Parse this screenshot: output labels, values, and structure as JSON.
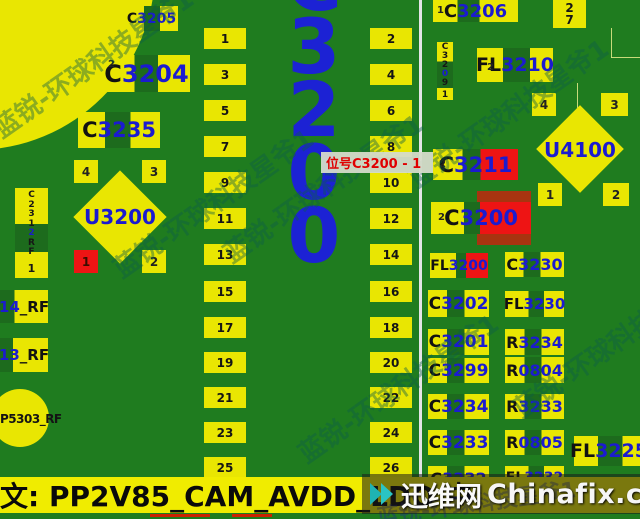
{
  "colors": {
    "board_green": "#1f7c1f",
    "pad_yellow": "#e9e602",
    "mid_green": "#1d6b1d",
    "highlight_red": "#ee1414",
    "marker_dark_red": "#a83410",
    "label_blue": "#1b1bd0",
    "big_label_blue": "#1c22d4",
    "tooltip_text_red": "#e00000",
    "bar_yellow": "#f0ec00"
  },
  "big_label": {
    "text": "C3200"
  },
  "tooltip": {
    "text": "位号C3200 - 1"
  },
  "connector": {
    "left_pins": [
      "1",
      "3",
      "5",
      "7",
      "9",
      "11",
      "13",
      "15",
      "17",
      "19",
      "21",
      "23",
      "25"
    ],
    "right_pins": [
      "2",
      "4",
      "6",
      "8",
      "10",
      "12",
      "14",
      "16",
      "18",
      "20",
      "22",
      "24",
      "26"
    ]
  },
  "refs": {
    "c3205": {
      "p": "C",
      "d": "3205"
    },
    "c3204": {
      "p": "C",
      "d": "3204",
      "pad": "2"
    },
    "c3235": {
      "p": "C",
      "d": "3235"
    },
    "u3200": {
      "label": "U3200",
      "pads": [
        "4",
        "3",
        "1",
        "2"
      ]
    },
    "c2312": {
      "t1": "C231",
      "t2": "2",
      "t3": "RF",
      "pad": "1"
    },
    "rf14": {
      "num": "14",
      "suffix": "_RF"
    },
    "rf13": {
      "num": "13",
      "suffix": "_RF"
    },
    "p5303": {
      "label": "P5303_RF"
    },
    "c3206": {
      "p": "C",
      "d": "3206",
      "pad": "1"
    },
    "pad27": {
      "a": "2",
      "b": "7"
    },
    "c3209": {
      "t1": "C32",
      "t2": "0",
      "t3": "9",
      "pad": "1"
    },
    "fl3210": {
      "p": "FL",
      "d": "3210",
      "pad": "2"
    },
    "u4100": {
      "label": "U4100",
      "pads": [
        "4",
        "3",
        "1",
        "2"
      ]
    },
    "c3211": {
      "p": "C",
      "d": "3211",
      "pad": "2"
    },
    "c3200": {
      "p": "C",
      "d": "3200",
      "pad": "2"
    },
    "fl3200": {
      "p": "FL",
      "d": "3200"
    },
    "c3230": {
      "p": "C",
      "d": "3230"
    },
    "c3202": {
      "p": "C",
      "d": "3202"
    },
    "fl3230": {
      "p": "FL",
      "d": "3230"
    },
    "c3201": {
      "p": "C",
      "d": "3201"
    },
    "r3234": {
      "p": "R",
      "d": "3234"
    },
    "c3299": {
      "p": "C",
      "d": "3299"
    },
    "r0804": {
      "p": "R",
      "d": "0804"
    },
    "c3234": {
      "p": "C",
      "d": "3234"
    },
    "r3233": {
      "p": "R",
      "d": "3233"
    },
    "c3233": {
      "p": "C",
      "d": "3233"
    },
    "r0805": {
      "p": "R",
      "d": "0805"
    },
    "c3232": {
      "p": "C",
      "d": "3232"
    },
    "fl3232": {
      "p": "FL",
      "d": "3232"
    },
    "fl3225": {
      "p": "FL",
      "d": "3225"
    }
  },
  "bottom_bar": {
    "text": "文: PP2V85_CAM_AVDD_LDO 中"
  },
  "watermark": {
    "badge": "迅维网",
    "site": "Chinafix.com",
    "diagonal": "蓝锐-环球科技星爷1"
  }
}
